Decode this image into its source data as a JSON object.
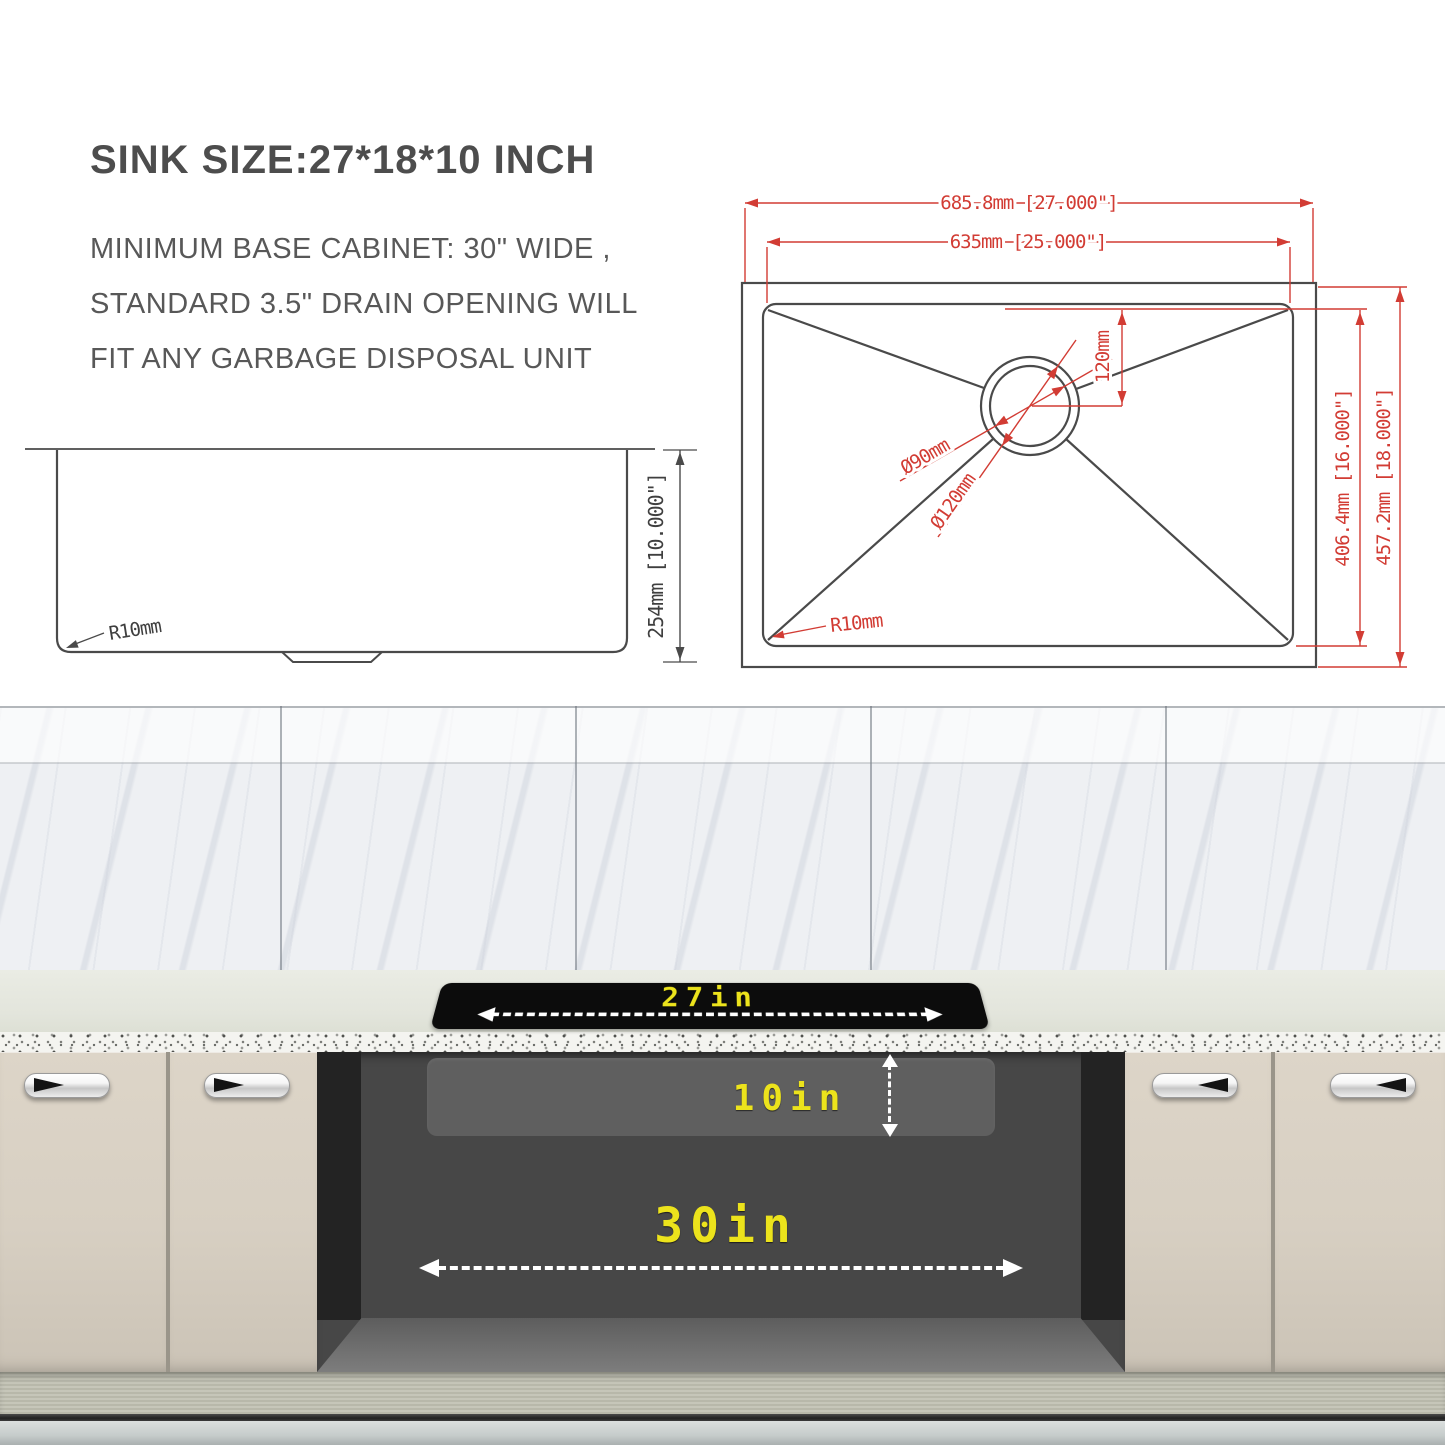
{
  "header": {
    "title": "SINK SIZE:27*18*10 INCH",
    "description_lines": [
      "MINIMUM BASE CABINET: 30\" WIDE ,",
      "STANDARD 3.5\" DRAIN OPENING WILL",
      "FIT ANY GARBAGE DISPOSAL UNIT"
    ]
  },
  "side_view": {
    "height_dim": "254mm  [10.000\"]",
    "corner_radius": "R10mm"
  },
  "top_view": {
    "overall_width": "685.8mm  [27.000\"]",
    "bowl_width": "635mm  [25.000\"]",
    "drain_offset": "120mm",
    "drain_diameter_inner": "Ø90mm",
    "drain_diameter_outer": "Ø120mm",
    "bowl_depth": "406.4mm  [16.000\"]",
    "overall_depth": "457.2mm  [18.000\"]",
    "corner_radius": "R10mm"
  },
  "installation_view": {
    "sink_width": "27in",
    "sink_depth": "10in",
    "min_cabinet_width": "30in"
  },
  "colors": {
    "dimension_red": "#d23c34",
    "drawing_gray": "#4a4a4a",
    "highlight_yellow": "#ece31c",
    "cutout_black": "#0c0c0c",
    "cabinet_beige": "#d7cfc2",
    "interior_gray": "#474747"
  }
}
